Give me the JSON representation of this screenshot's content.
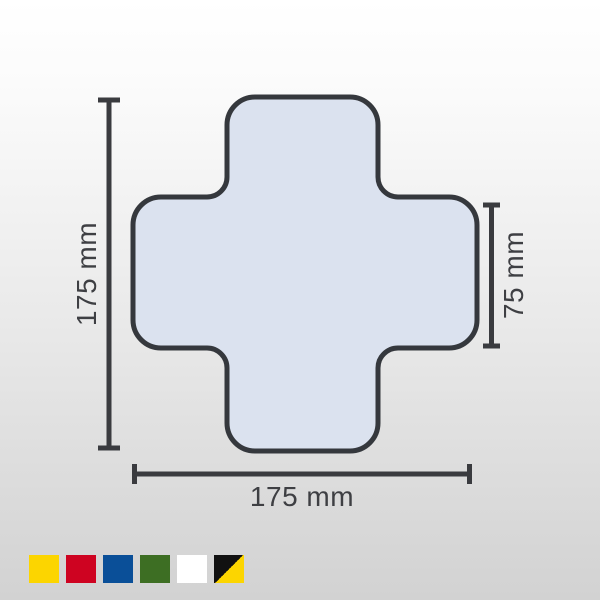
{
  "diagram": {
    "shape_name": "rounded-cross-floor-marking",
    "dimensions": {
      "height_label": "175 mm",
      "width_label": "175 mm",
      "arm_label": "75 mm"
    },
    "colors": {
      "cross_fill": "#dbe2ef",
      "cross_outline": "#35383d",
      "dimension_line": "#3a3b3f",
      "label_text": "#3e3f43"
    }
  },
  "swatches": {
    "items": [
      {
        "name": "yellow",
        "colors": [
          "#fcd500"
        ]
      },
      {
        "name": "red",
        "colors": [
          "#ce0321"
        ]
      },
      {
        "name": "blue",
        "colors": [
          "#0a4f98"
        ]
      },
      {
        "name": "green",
        "colors": [
          "#3d6e23"
        ]
      },
      {
        "name": "white",
        "colors": [
          "#ffffff"
        ]
      },
      {
        "name": "black-yellow",
        "colors": [
          "#111111",
          "#fcd500"
        ]
      }
    ]
  }
}
